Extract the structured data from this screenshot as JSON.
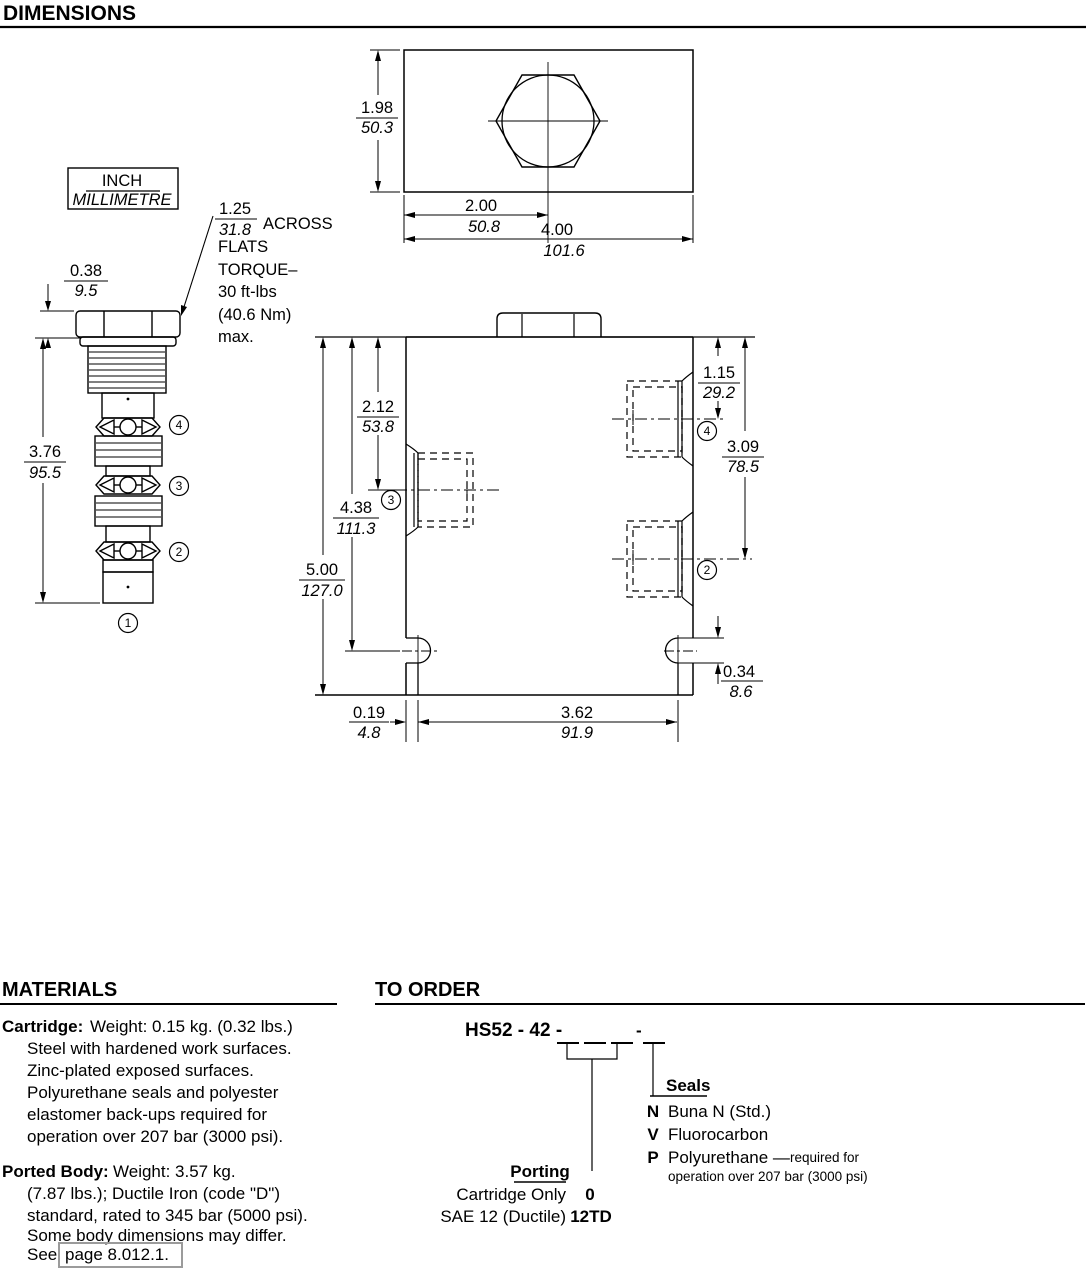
{
  "headers": {
    "dimensions": "DIMENSIONS",
    "materials": "MATERIALS",
    "to_order": "TO ORDER"
  },
  "units_box": {
    "inch": "INCH",
    "mm": "MILLIMETRE"
  },
  "torque": {
    "in": "1.25",
    "mm": "31.8",
    "across": "ACROSS",
    "flats": "FLATS",
    "torque": "TORQUE–",
    "ftlbs": "30 ft-lbs",
    "nm": "(40.6 Nm)",
    "max": "max."
  },
  "dims": {
    "top_height": {
      "in": "1.98",
      "mm": "50.3"
    },
    "top_center": {
      "in": "2.00",
      "mm": "50.8"
    },
    "top_width": {
      "in": "4.00",
      "mm": "101.6"
    },
    "hex_h": {
      "in": "0.38",
      "mm": "9.5"
    },
    "cart_len": {
      "in": "3.76",
      "mm": "95.5"
    },
    "body_h": {
      "in": "5.00",
      "mm": "127.0"
    },
    "slot_v": {
      "in": "4.38",
      "mm": "111.3"
    },
    "port3_v": {
      "in": "2.12",
      "mm": "53.8"
    },
    "port4_v": {
      "in": "1.15",
      "mm": "29.2"
    },
    "port2_v": {
      "in": "3.09",
      "mm": "78.5"
    },
    "slot_h": {
      "in": "0.34",
      "mm": "8.6"
    },
    "slot_off": {
      "in": "0.19",
      "mm": "4.8"
    },
    "slot_span": {
      "in": "3.62",
      "mm": "91.9"
    }
  },
  "port_labels": {
    "p1": "1",
    "p2": "2",
    "p3": "3",
    "p4": "4"
  },
  "materials": {
    "cartridge_label": "Cartridge:",
    "cartridge_intro": "Weight: 0.15 kg. (0.32 lbs.)",
    "cartridge_lines": [
      "Steel with hardened work surfaces.",
      "Zinc-plated exposed surfaces.",
      "Polyurethane seals and polyester",
      "elastomer back-ups required for",
      "operation over 207 bar (3000 psi)."
    ],
    "body_label": "Ported Body:",
    "body_intro": "Weight: 3.57 kg.",
    "body_lines": [
      "(7.87 lbs.); Ductile Iron (code \"D\")",
      "standard, rated to 345 bar (5000 psi).",
      "Some body dimensions may differ."
    ],
    "see": "See",
    "page_link": "page 8.012.1."
  },
  "to_order": {
    "model_code": "HS52 - 42 -",
    "dash": "-",
    "seals_label": "Seals",
    "seal_options": [
      {
        "code": "N",
        "name": "Buna N (Std.)",
        "note": ""
      },
      {
        "code": "V",
        "name": "Fluorocarbon",
        "note": ""
      },
      {
        "code": "P",
        "name": "Polyurethane —",
        "note": "required for"
      }
    ],
    "seal_note_cont": "operation over 207 bar (3000 psi)",
    "porting_label": "Porting",
    "porting_options": [
      {
        "name": "Cartridge Only",
        "code": "0"
      },
      {
        "name": "SAE 12 (Ductile)",
        "code": "12TD"
      }
    ]
  }
}
